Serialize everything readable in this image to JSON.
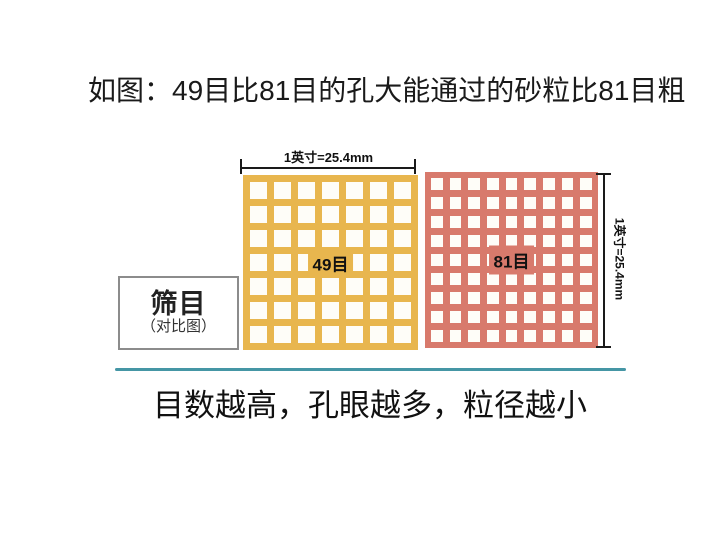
{
  "title": "如图：49目比81目的孔大能通过的砂粒比81目粗",
  "dimensions": {
    "top_label": "1英寸=25.4mm",
    "right_label": "1英寸=25.4mm"
  },
  "meshes": [
    {
      "id": "mesh-49",
      "label": "49目",
      "rows": 7,
      "cols": 7,
      "color": "#e8b64e",
      "hole_color": "#fefdf8"
    },
    {
      "id": "mesh-81",
      "label": "81目",
      "rows": 9,
      "cols": 9,
      "color": "#d87a6c",
      "hole_color": "#fefdf8"
    }
  ],
  "legend_box": {
    "title": "筛目",
    "subtitle": "（对比图）"
  },
  "caption": "目数越高，孔眼越多，粒径越小",
  "colors": {
    "mesh49": "#e8b64e",
    "mesh81": "#d87a6c",
    "divider": "#4596a5",
    "dimension_line": "#1a1a1a",
    "box_border": "#8c8c8c"
  }
}
